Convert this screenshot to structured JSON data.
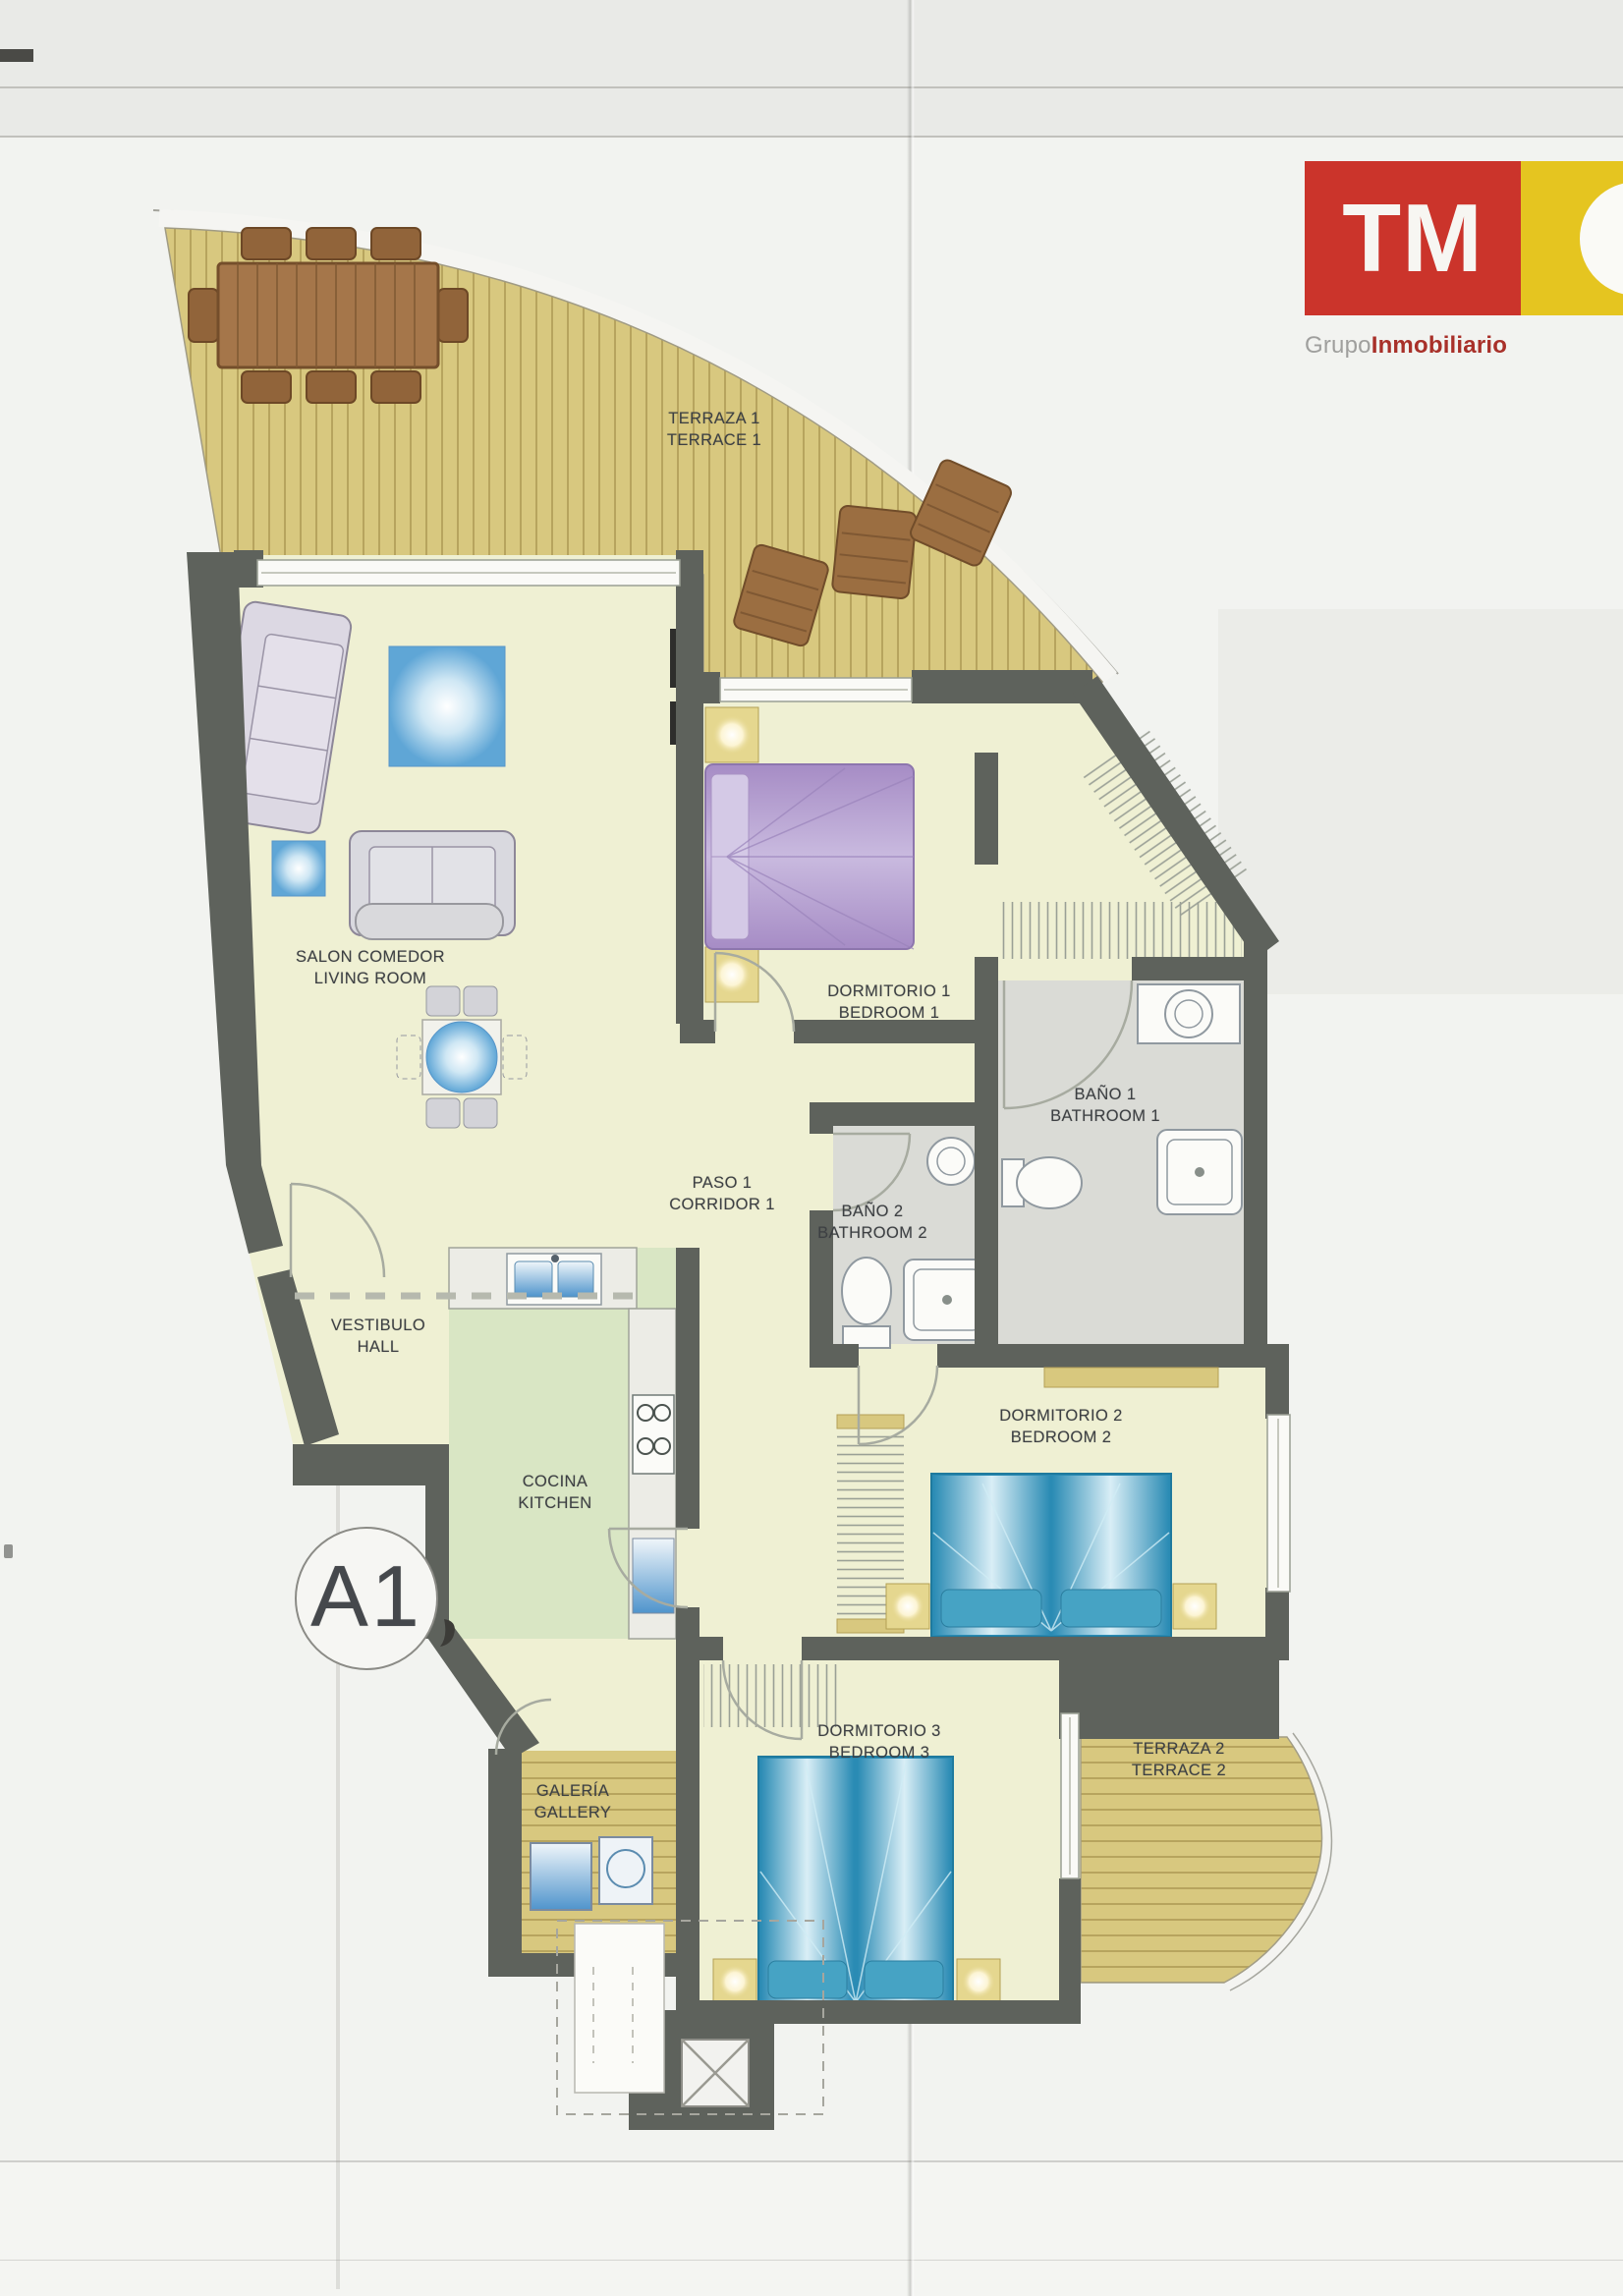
{
  "logo": {
    "monogram": "TM",
    "subtitle_gray": "Grupo",
    "subtitle_red": "Inmobiliario",
    "brand_red": "#cb342b",
    "brand_yellow": "#e5c520"
  },
  "plan": {
    "unit_label": "A1",
    "rooms": [
      {
        "id": "terraza1",
        "es": "TERRAZA 1",
        "en": "TERRACE 1"
      },
      {
        "id": "salon",
        "es": "SALON COMEDOR",
        "en": "LIVING ROOM"
      },
      {
        "id": "dormitorio1",
        "es": "DORMITORIO 1",
        "en": "BEDROOM 1"
      },
      {
        "id": "bano1",
        "es": "BAÑO 1",
        "en": "BATHROOM 1"
      },
      {
        "id": "paso1",
        "es": "PASO 1",
        "en": "CORRIDOR 1"
      },
      {
        "id": "bano2",
        "es": "BAÑO 2",
        "en": "BATHROOM 2"
      },
      {
        "id": "vestibulo",
        "es": "VESTIBULO",
        "en": "HALL"
      },
      {
        "id": "cocina",
        "es": "COCINA",
        "en": "KITCHEN"
      },
      {
        "id": "dormitorio2",
        "es": "DORMITORIO 2",
        "en": "BEDROOM 2"
      },
      {
        "id": "dormitorio3",
        "es": "DORMITORIO 3",
        "en": "BEDROOM 3"
      },
      {
        "id": "galeria",
        "es": "GALERÍA",
        "en": "GALLERY"
      },
      {
        "id": "terraza2",
        "es": "TERRAZA 2",
        "en": "TERRACE 2"
      }
    ]
  },
  "colors": {
    "wall": "#5e625c",
    "floor": "#eff0d3",
    "kitchen_floor": "#d9e6c4",
    "bath_floor": "#dadbd6",
    "deck_wood": "#d8c87f",
    "bed_blue": "#2a8bb4",
    "bed_purple": "#b29bcf"
  }
}
